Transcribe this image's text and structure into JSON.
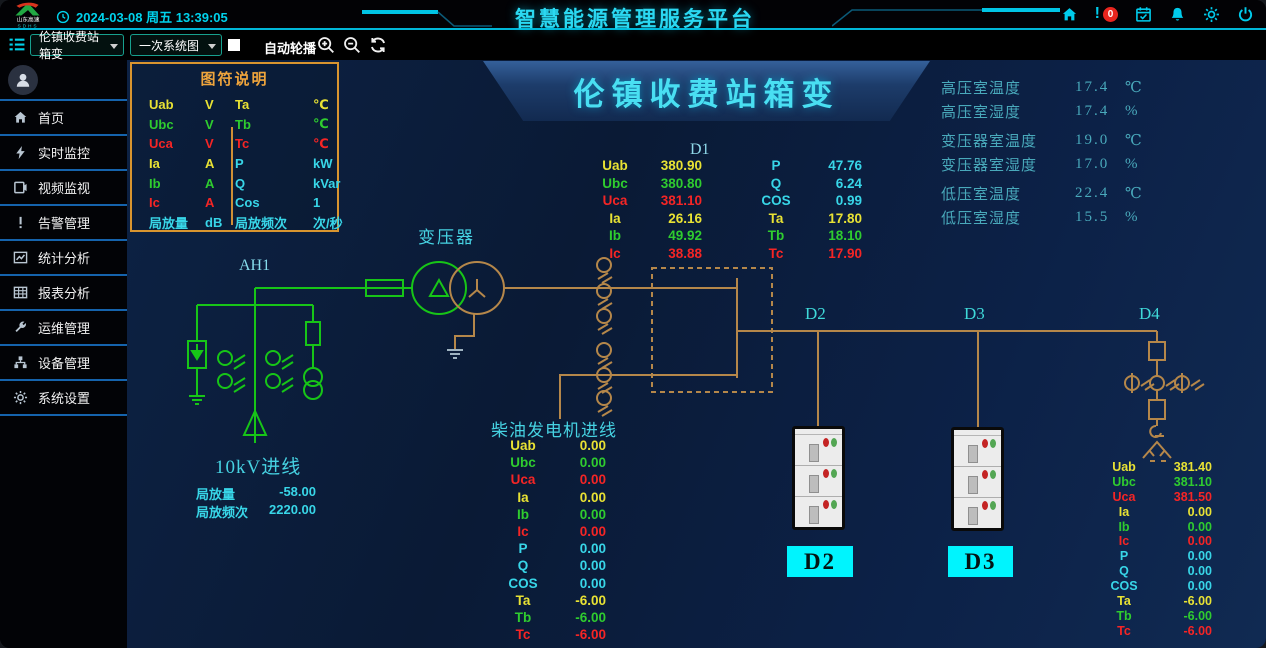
{
  "header": {
    "logo_line1": "山东高速",
    "logo_line2": "SDHS",
    "datetime": "2024-03-08 周五 13:39:05",
    "title": "智慧能源管理服务平台",
    "alarm_badge": "0"
  },
  "toolbar": {
    "station_dropdown": "伦镇收费站箱变",
    "view_dropdown": "一次系统图",
    "auto_rotate_label": "自动轮播"
  },
  "sidebar": {
    "items": [
      {
        "icon": "home-icon",
        "label": "首页"
      },
      {
        "icon": "lightning-icon",
        "label": "实时监控"
      },
      {
        "icon": "video-icon",
        "label": "视频监视"
      },
      {
        "icon": "alert-icon",
        "label": "告警管理"
      },
      {
        "icon": "line-chart-icon",
        "label": "统计分析"
      },
      {
        "icon": "table-icon",
        "label": "报表分析"
      },
      {
        "icon": "wrench-icon",
        "label": "运维管理"
      },
      {
        "icon": "devices-icon",
        "label": "设备管理"
      },
      {
        "icon": "gear-icon",
        "label": "系统设置"
      }
    ]
  },
  "legend": {
    "title": "图符说明",
    "rows": [
      {
        "s1": "Uab",
        "u1": "V",
        "c1": "y",
        "s2": "Ta",
        "u2": "℃",
        "c2": "y"
      },
      {
        "s1": "Ubc",
        "u1": "V",
        "c1": "g",
        "s2": "Tb",
        "u2": "℃",
        "c2": "g"
      },
      {
        "s1": "Uca",
        "u1": "V",
        "c1": "r",
        "s2": "Tc",
        "u2": "℃",
        "c2": "r"
      },
      {
        "s1": "Ia",
        "u1": "A",
        "c1": "y",
        "s2": "P",
        "u2": "kW",
        "c2": "c"
      },
      {
        "s1": "Ib",
        "u1": "A",
        "c1": "g",
        "s2": "Q",
        "u2": "kVar",
        "c2": "c"
      },
      {
        "s1": "Ic",
        "u1": "A",
        "c1": "r",
        "s2": "Cos",
        "u2": "1",
        "c2": "c"
      },
      {
        "s1": "局放量",
        "u1": "dB",
        "c1": "c",
        "s2": "局放频次",
        "u2": "次/秒",
        "c2": "c"
      }
    ]
  },
  "banner": {
    "title": "伦镇收费站箱变"
  },
  "env_panel": {
    "rows": [
      {
        "label": "高压室温度",
        "value": "17.4",
        "unit": "℃"
      },
      {
        "label": "高压室湿度",
        "value": "17.4",
        "unit": "%"
      },
      {
        "label": "变压器室温度",
        "value": "19.0",
        "unit": "℃"
      },
      {
        "label": "变压器室湿度",
        "value": "17.0",
        "unit": "%"
      },
      {
        "label": "低压室温度",
        "value": "22.4",
        "unit": "℃"
      },
      {
        "label": "低压室湿度",
        "value": "15.5",
        "unit": "%"
      }
    ]
  },
  "d1_block": {
    "title": "D1",
    "left": [
      [
        "Uab",
        "380.90",
        "y"
      ],
      [
        "Ubc",
        "380.80",
        "g"
      ],
      [
        "Uca",
        "381.10",
        "r"
      ],
      [
        "Ia",
        "26.16",
        "y"
      ],
      [
        "Ib",
        "49.92",
        "g"
      ],
      [
        "Ic",
        "38.88",
        "r"
      ]
    ],
    "right": [
      [
        "P",
        "47.76",
        "c"
      ],
      [
        "Q",
        "6.24",
        "c"
      ],
      [
        "COS",
        "0.99",
        "c"
      ],
      [
        "Ta",
        "17.80",
        "y"
      ],
      [
        "Tb",
        "18.10",
        "g"
      ],
      [
        "Tc",
        "17.90",
        "r"
      ]
    ]
  },
  "diagram": {
    "transformer_label": "变压器",
    "feeder_label": "AH1",
    "incoming_label": "10kV进线",
    "pd_rows": [
      [
        "局放量",
        "-58.00"
      ],
      [
        "局放频次",
        "2220.00"
      ]
    ],
    "d2_label": "D2",
    "d3_label": "D3",
    "d4_label": "D4",
    "d2_box": "D2",
    "d3_box": "D3"
  },
  "diesel_block": {
    "title": "柴油发电机进线",
    "rows": [
      [
        "Uab",
        "0.00",
        "y"
      ],
      [
        "Ubc",
        "0.00",
        "g"
      ],
      [
        "Uca",
        "0.00",
        "r"
      ],
      [
        "Ia",
        "0.00",
        "y"
      ],
      [
        "Ib",
        "0.00",
        "g"
      ],
      [
        "Ic",
        "0.00",
        "r"
      ],
      [
        "P",
        "0.00",
        "c"
      ],
      [
        "Q",
        "0.00",
        "c"
      ],
      [
        "COS",
        "0.00",
        "c"
      ],
      [
        "Ta",
        "-6.00",
        "y"
      ],
      [
        "Tb",
        "-6.00",
        "g"
      ],
      [
        "Tc",
        "-6.00",
        "r"
      ]
    ]
  },
  "d4_block": {
    "rows": [
      [
        "Uab",
        "381.40",
        "y"
      ],
      [
        "Ubc",
        "381.10",
        "g"
      ],
      [
        "Uca",
        "381.50",
        "r"
      ],
      [
        "Ia",
        "0.00",
        "y"
      ],
      [
        "Ib",
        "0.00",
        "g"
      ],
      [
        "Ic",
        "0.00",
        "r"
      ],
      [
        "P",
        "0.00",
        "c"
      ],
      [
        "Q",
        "0.00",
        "c"
      ],
      [
        "COS",
        "0.00",
        "c"
      ],
      [
        "Ta",
        "-6.00",
        "y"
      ],
      [
        "Tb",
        "-6.00",
        "g"
      ],
      [
        "Tc",
        "-6.00",
        "r"
      ]
    ]
  },
  "colors": {
    "yellow": "#e8e234",
    "green": "#2fcc2f",
    "red": "#f52525",
    "cyan": "#38d6e8",
    "orange_line": "#b5874a",
    "green_line": "#17c517",
    "accent": "#00d0ec",
    "legend_orange": "#f0a53c",
    "label_box_bg": "#00f4fe",
    "alarm_red": "#e8251e"
  }
}
